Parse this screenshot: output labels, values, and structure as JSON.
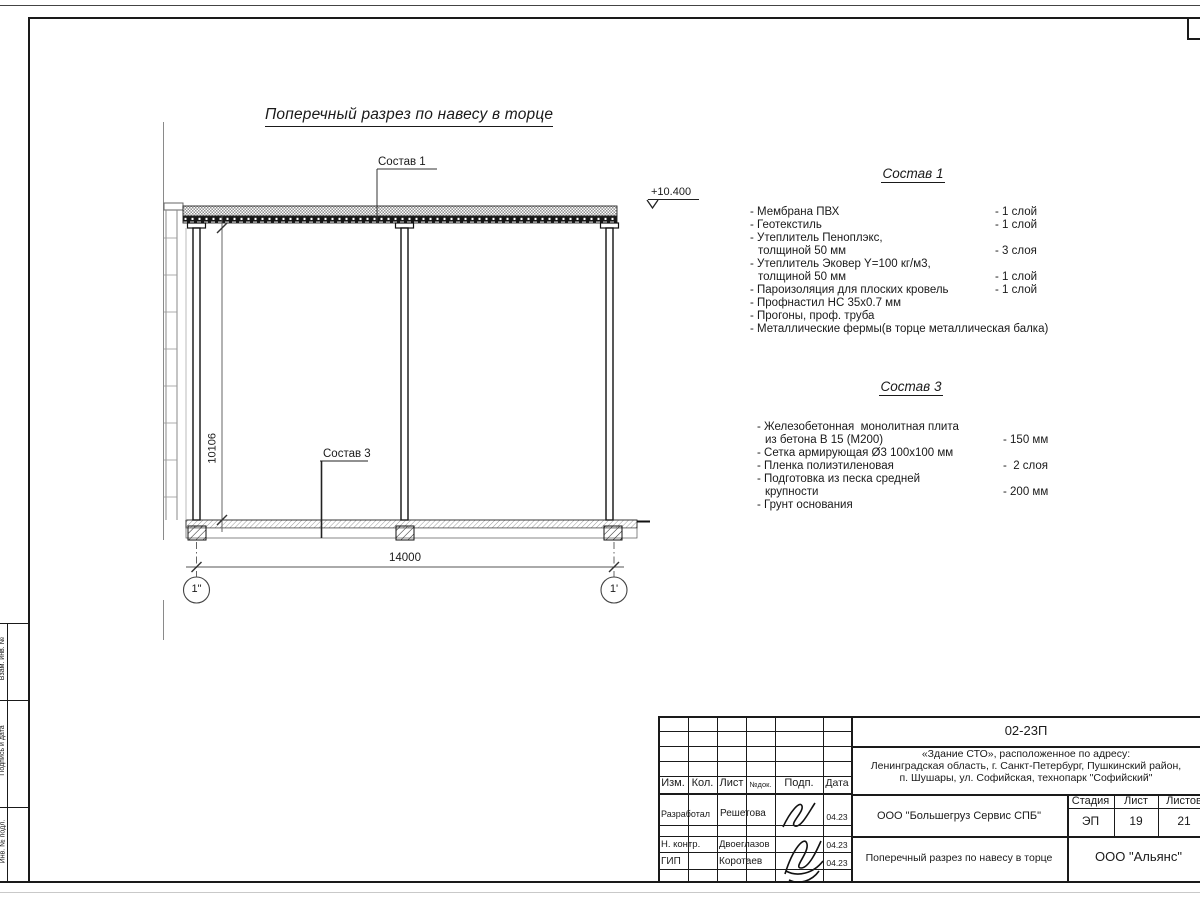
{
  "colors": {
    "line": "#1a1a1a",
    "thin_line": "#8a8a8a",
    "paper": "#ffffff"
  },
  "drawing": {
    "title": "Поперечный разрез по навесу в торце",
    "leader_top": "Состав 1",
    "leader_slab": "Состав 3",
    "elevation": "+10.400",
    "dim_width": "14000",
    "dim_height": "10106",
    "axis_left": "1\"",
    "axis_right": "1'"
  },
  "sostav1": {
    "heading": "Состав 1",
    "items": [
      {
        "name": "- Мембрана ПВХ",
        "value": "- 1 слой"
      },
      {
        "name": "- Геотекстиль",
        "value": "- 1 слой"
      },
      {
        "name": "- Утеплитель Пеноплэкс,",
        "value": ""
      },
      {
        "name": "толщиной 50 мм",
        "value": "- 3 слоя"
      },
      {
        "name": "- Утеплитель Эковер Y=100 кг/м3,",
        "value": ""
      },
      {
        "name": "толщиной 50 мм",
        "value": "- 1 слой"
      },
      {
        "name": "- Пароизоляция для плоских кровель",
        "value": "- 1 слой"
      },
      {
        "name": "- Профнастил НС 35х0.7 мм",
        "value": ""
      },
      {
        "name": "- Прогоны, проф. труба",
        "value": ""
      },
      {
        "name": "- Металлические фермы(в торце металлическая балка)",
        "value": ""
      }
    ]
  },
  "sostav3": {
    "heading": "Состав 3",
    "items": [
      {
        "name": "- Железобетонная  монолитная плита",
        "value": ""
      },
      {
        "name": "из бетона В 15 (М200)",
        "value": "- 150 мм"
      },
      {
        "name": "- Сетка армирующая Ø3 100х100 мм",
        "value": ""
      },
      {
        "name": "- Пленка полиэтиленовая",
        "value": "-  2 слоя"
      },
      {
        "name": "- Подготовка из песка средней",
        "value": ""
      },
      {
        "name": "крупности",
        "value": "- 200 мм"
      },
      {
        "name": "- Грунт основания",
        "value": ""
      }
    ]
  },
  "frame_labels": {
    "vzam": "Взам. инв. №",
    "podpis": "Подпись и дата",
    "inv": "Инв. № подл."
  },
  "titleblock": {
    "doc_code": "02-23П",
    "object_line1": "«Здание СТО», расположенное по адресу:",
    "object_line2": "Ленинградская область, г. Санкт-Петербург, Пушкинский район,",
    "object_line3": "п. Шушары, ул. Софийская, технопарк \"Софийский\"",
    "col_izm": "Изм.",
    "col_kol": "Кол.",
    "col_list": "Лист",
    "col_ndok": "№док.",
    "col_podp": "Подп.",
    "col_data": "Дата",
    "row1_role": "Разработал",
    "row1_name": "Решетова",
    "row1_date": "04.23",
    "row2_role": "Н. контр.",
    "row2_name": "Двоеглазов",
    "row2_date": "04.23",
    "row3_role": "ГИП",
    "row3_name": "Коротаев",
    "row3_date": "04.23",
    "company": "ООО \"Большегруз Сервис СПБ\"",
    "stage_label": "Стадия",
    "sheet_label": "Лист",
    "sheets_label": "Листов",
    "stage": "ЭП",
    "sheet_no": "19",
    "sheets_total": "21",
    "drawing_name": "Поперечный разрез по навесу в торце",
    "org": "ООО \"Альянс\""
  }
}
